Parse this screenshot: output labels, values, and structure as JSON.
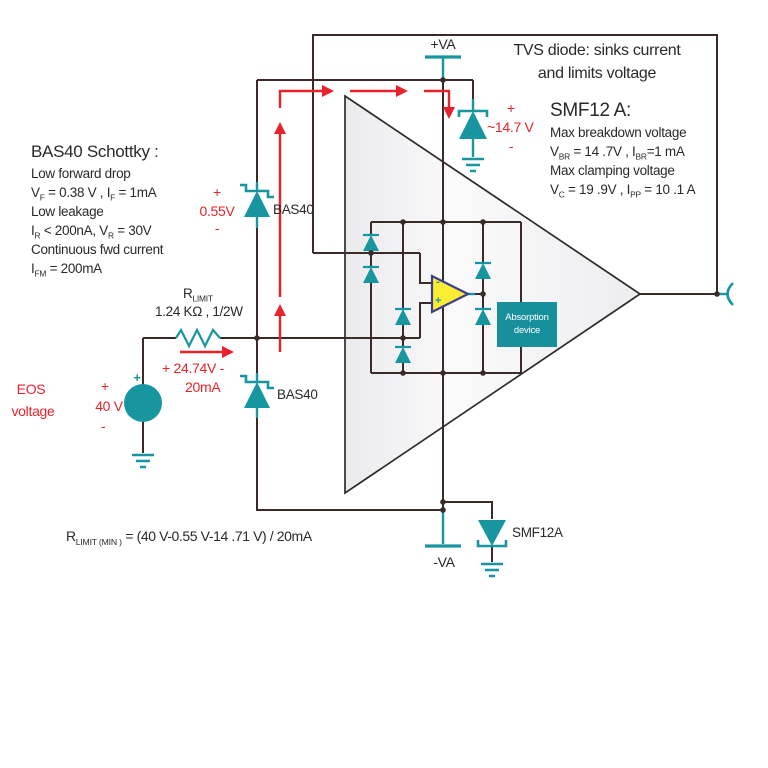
{
  "colors": {
    "teal": "#1796A0",
    "red": "#E8222A",
    "wire": "#3A2A28",
    "ink": "#2B2829",
    "opamp_fill": "#F9EC31",
    "opamp_border": "#3D3C8F",
    "triangle_outline": "#2E2B2C"
  },
  "top": {
    "vpos_label": "+VA",
    "tvs_note1": "TVS diode: sinks current",
    "tvs_note2": "and limits voltage",
    "tvs_plus": "+",
    "tvs_value": "~14.7 V",
    "tvs_minus": "-"
  },
  "smf12": {
    "title": "SMF12 A:",
    "line1": "Max breakdown voltage",
    "line2": [
      {
        "t": "V"
      },
      {
        "s": "BR"
      },
      {
        "t": " = 14 .7V , I"
      },
      {
        "s": "BR"
      },
      {
        "t": "=1 mA"
      }
    ],
    "line3": "Max clamping voltage",
    "line4": [
      {
        "t": "V"
      },
      {
        "s": "C"
      },
      {
        "t": " = 19 .9V , I"
      },
      {
        "s": "PP"
      },
      {
        "t": " = 10 .1 A"
      }
    ]
  },
  "bas40_note": {
    "title": "BAS40 Schottky    :",
    "line1": "Low forward drop",
    "line2": [
      {
        "t": "V"
      },
      {
        "s": "F"
      },
      {
        "t": " = 0.38 V ,  I"
      },
      {
        "s": "F"
      },
      {
        "t": " = 1mA"
      }
    ],
    "line3": "Low leakage",
    "line4": [
      {
        "t": "I"
      },
      {
        "s": "R"
      },
      {
        "t": " < 200nA,   V"
      },
      {
        "s": "R"
      },
      {
        "t": " = 30V"
      }
    ],
    "line5": "Continuous fwd current",
    "line6": [
      {
        "t": "I"
      },
      {
        "s": "FM"
      },
      {
        "t": " = 200mA"
      }
    ]
  },
  "diode1": {
    "plus": "+",
    "value": "0.55V",
    "minus": "-",
    "label": "BAS40"
  },
  "diode2": {
    "label": "BAS40"
  },
  "resistor": {
    "name": [
      {
        "t": "R"
      },
      {
        "s": "LIMIT"
      }
    ],
    "value": "1.24 KΩ , 1/2W",
    "drop": "+ 24.74V -",
    "current": "20mA"
  },
  "source": {
    "name1": "EOS",
    "name2": "voltage",
    "plus": "+",
    "value": "40 V",
    "minus": "-",
    "terminal_plus": "+"
  },
  "opamp": {
    "minus": "-",
    "plus": "+",
    "absorption1": "Absorption",
    "absorption2": "device"
  },
  "bottom": {
    "vneg_label": "-VA",
    "smf12a_label": "SMF12A",
    "formula": [
      {
        "t": "R"
      },
      {
        "s": "LIMIT (MIN )"
      },
      {
        "t": " = (40 V-0.55 V-14 .71 V) / 20mA"
      }
    ]
  }
}
